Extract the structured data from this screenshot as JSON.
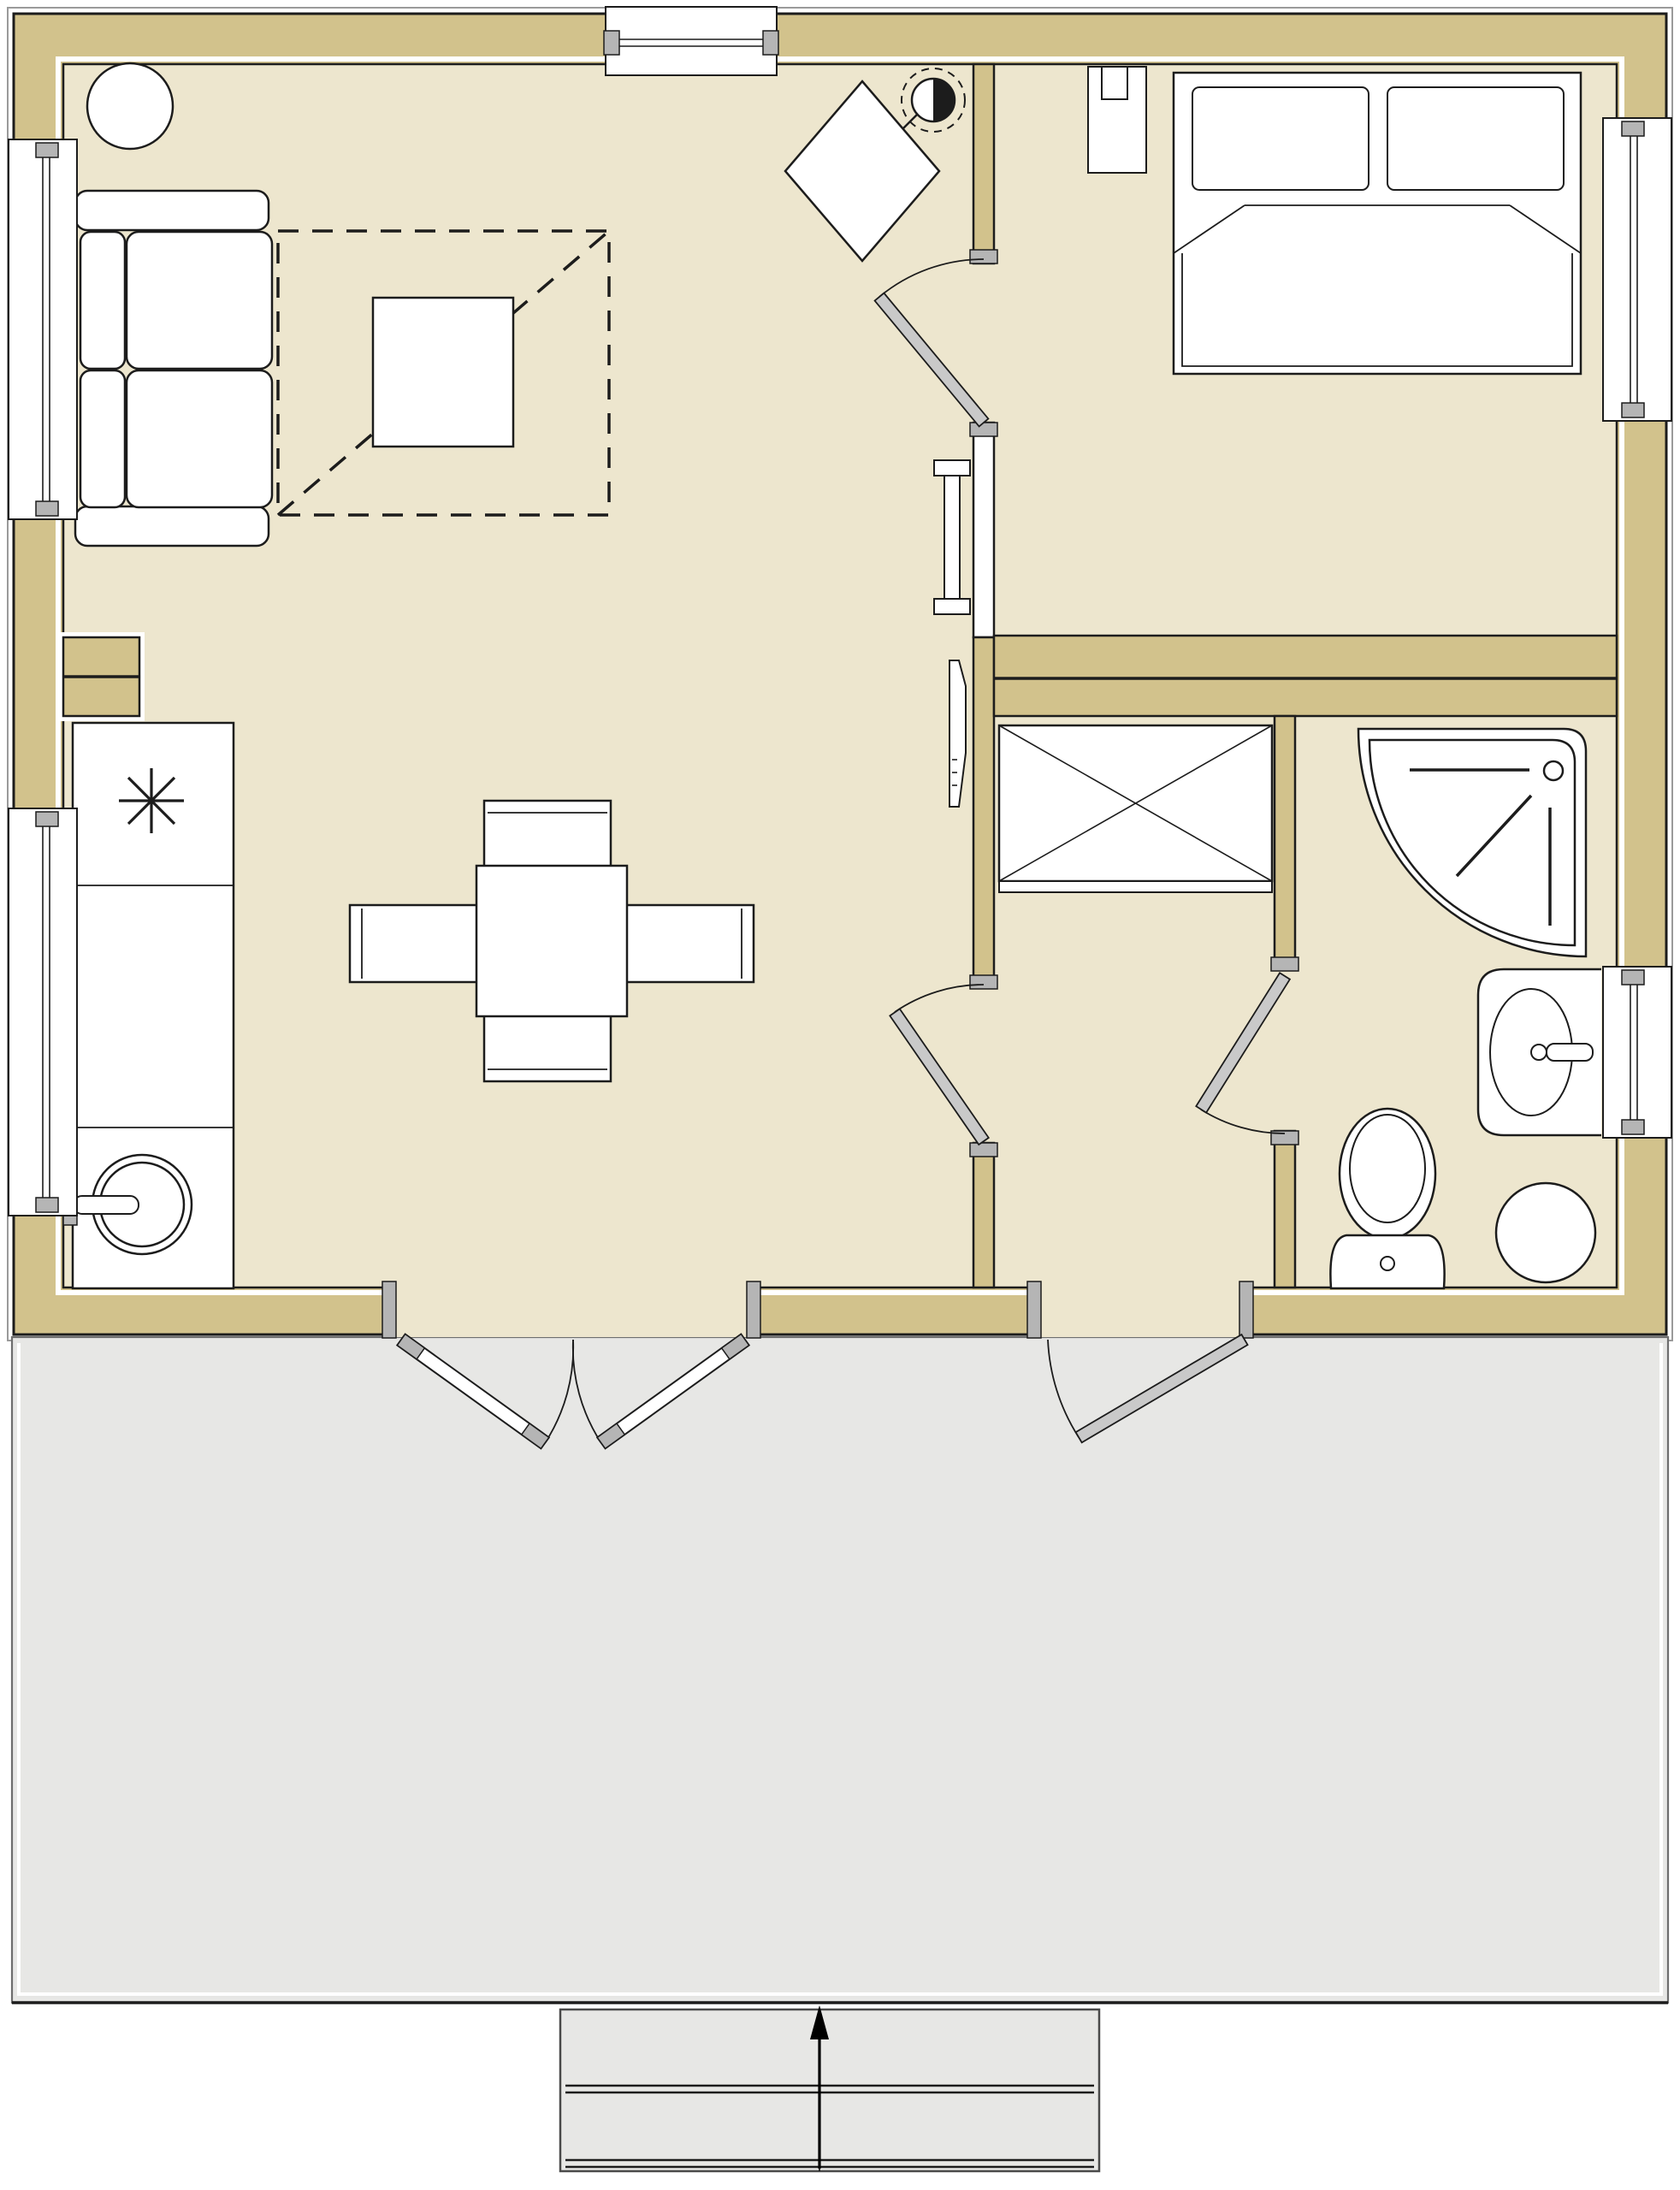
{
  "document": {
    "type": "floor-plan-drawing",
    "title": "One-bedroom cottage floor plan with deck",
    "visible_text": []
  },
  "colors": {
    "wall": "#d2c28c",
    "floor": "#ede6ce",
    "deck": "#e7e7e5",
    "line": "#1c1c1c",
    "leaf": "#c9c9c9",
    "jamb": "#b5b5b5",
    "white": "#ffffff",
    "trim": "#9a9a9a",
    "page": "#ffffff"
  },
  "inventory": {
    "rooms": [
      "living-room",
      "home-office-corner",
      "kitchen",
      "dining-area",
      "bedroom",
      "closet",
      "bathroom",
      "entry-hall",
      "deck"
    ],
    "fixtures": [
      "sofa",
      "round-side-table",
      "coffee-table",
      "dashed-ceiling-outline",
      "wall-media-unit",
      "wall-panel",
      "desk-rotated",
      "office-chair",
      "kitchen-counter",
      "cooktop-burner-symbol",
      "round-sink-with-faucet",
      "dining-table",
      "dining-chairs-x4",
      "bed-double",
      "pillows-x2",
      "nightstand",
      "table-lamp",
      "wardrobe-with-x",
      "corner-shower",
      "vanity-sink",
      "toilet",
      "round-hamper",
      "windows-x5",
      "hinged-doors-x4",
      "french-double-door",
      "deck-steps",
      "entry-direction-arrow"
    ],
    "door_count": 6,
    "window_count": 5,
    "step_count": 2
  }
}
